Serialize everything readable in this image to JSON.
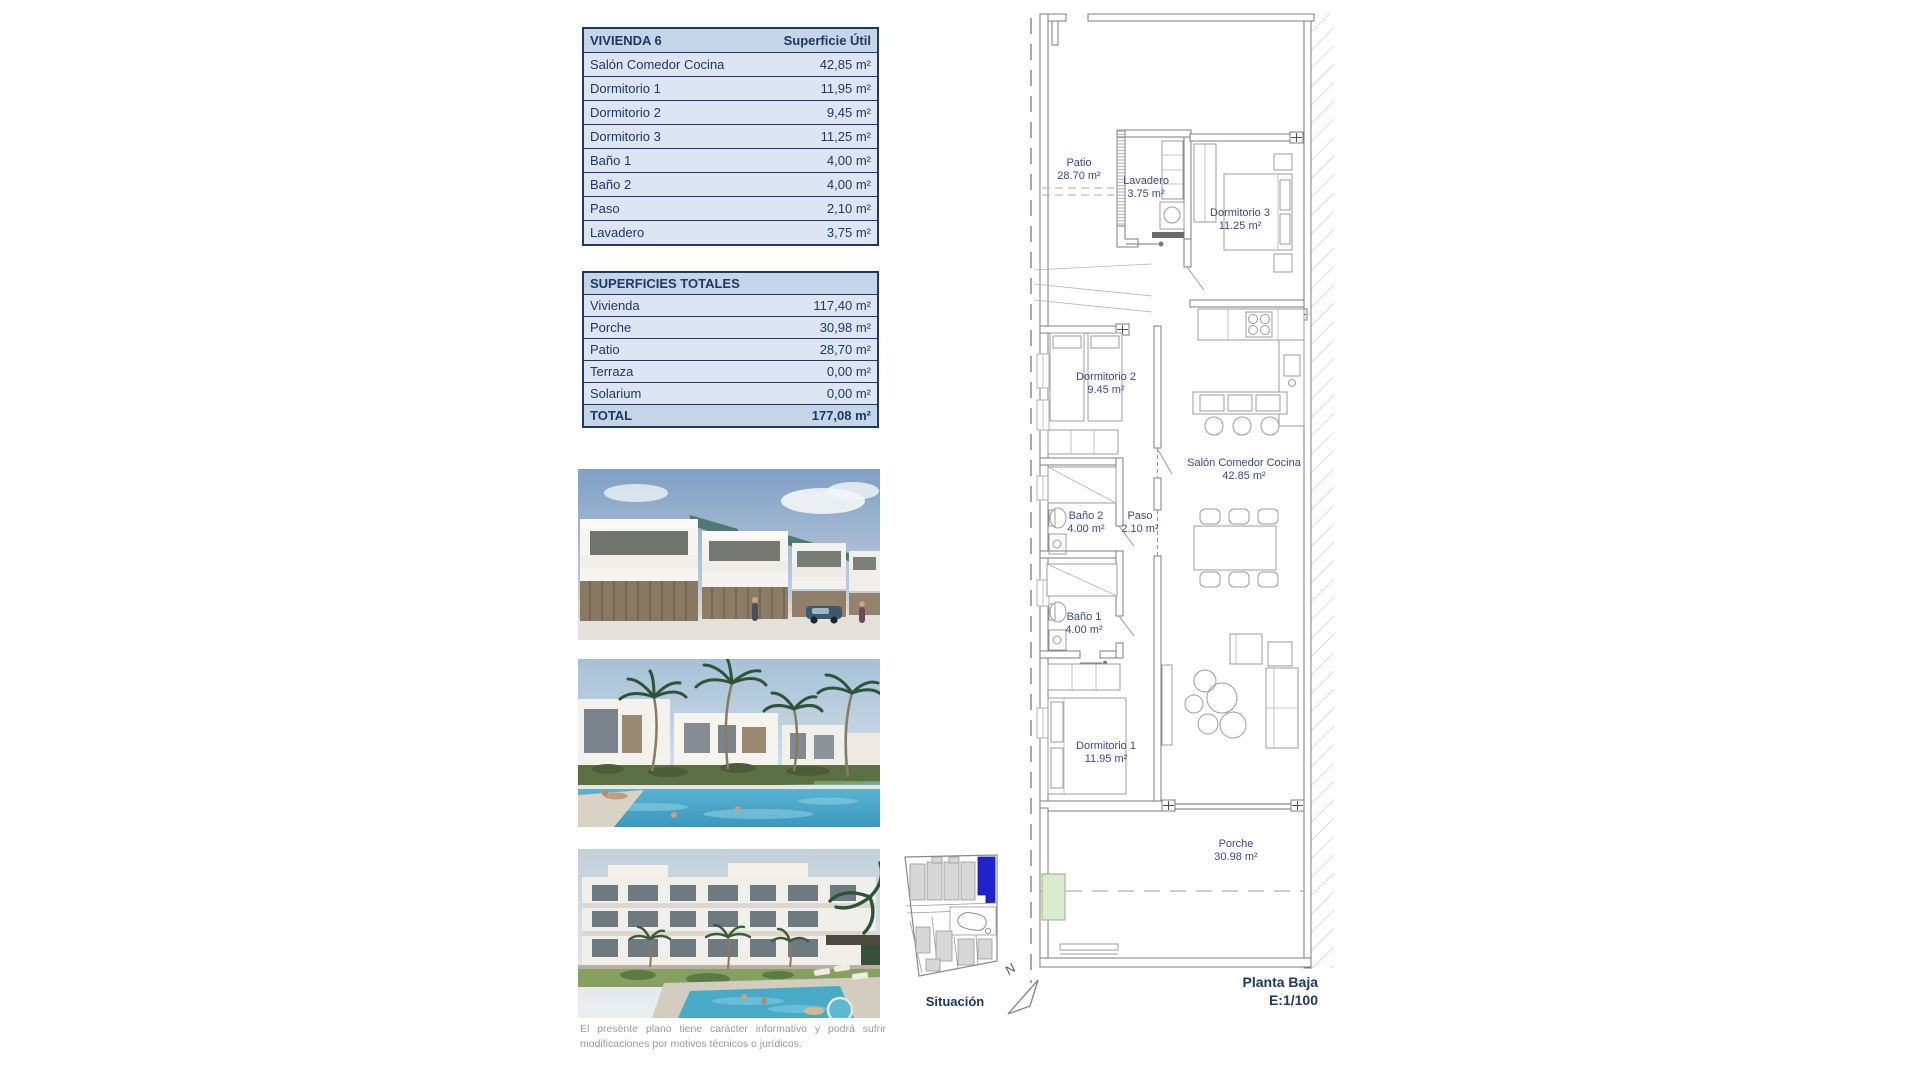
{
  "colors": {
    "navy_text": "#1f3864",
    "table_header_bg": "#c5d5e8",
    "table_row_bg": "#dce5f1",
    "highlight_unit_blue": "#2222cc",
    "plan_line_gray": "#7d7d7d",
    "planter_green": "#dcead0"
  },
  "tables": {
    "vivienda": {
      "title": "VIVIENDA 6",
      "col_header": "Superficie Útil",
      "rows": [
        {
          "label": "Salón Comedor Cocina",
          "value": "42,85 m²"
        },
        {
          "label": "Dormitorio 1",
          "value": "11,95 m²"
        },
        {
          "label": "Dormitorio 2",
          "value": "9,45 m²"
        },
        {
          "label": "Dormitorio 3",
          "value": "11,25 m²"
        },
        {
          "label": "Baño 1",
          "value": "4,00 m²"
        },
        {
          "label": "Baño 2",
          "value": "4,00 m²"
        },
        {
          "label": "Paso",
          "value": "2,10 m²"
        },
        {
          "label": "Lavadero",
          "value": "3,75 m²"
        }
      ]
    },
    "totales": {
      "title": "SUPERFICIES TOTALES",
      "rows": [
        {
          "label": "Vivienda",
          "value": "117,40 m²"
        },
        {
          "label": "Porche",
          "value": "30,98 m²"
        },
        {
          "label": "Patio",
          "value": "28,70 m²"
        },
        {
          "label": "Terraza",
          "value": "0,00 m²"
        },
        {
          "label": "Solarium",
          "value": "0,00 m²"
        }
      ],
      "total_label": "TOTAL",
      "total_value": "177,08 m²"
    }
  },
  "site_plan": {
    "caption": "Situación",
    "north_label": "N"
  },
  "floor_plan": {
    "rooms": [
      {
        "name": "Patio",
        "area": "28.70 m²"
      },
      {
        "name": "Lavadero",
        "area": "3.75 m²"
      },
      {
        "name": "Dormitorio 3",
        "area": "11.25 m²"
      },
      {
        "name": "Dormitorio 2",
        "area": "9.45 m²"
      },
      {
        "name": "Salón Comedor Cocina",
        "area": "42.85 m²"
      },
      {
        "name": "Baño 2",
        "area": "4.00 m²"
      },
      {
        "name": "Paso",
        "area": "2.10 m²"
      },
      {
        "name": "Baño 1",
        "area": "4.00 m²"
      },
      {
        "name": "Dormitorio 1",
        "area": "11.95 m²"
      },
      {
        "name": "Porche",
        "area": "30.98 m²"
      }
    ],
    "footer": {
      "title": "Planta Baja",
      "scale": "E:1/100"
    }
  },
  "disclaimer": "El presente plano tiene carácter informativo y podrá sufrir modificaciones por motivos técnicos o jurídicos."
}
